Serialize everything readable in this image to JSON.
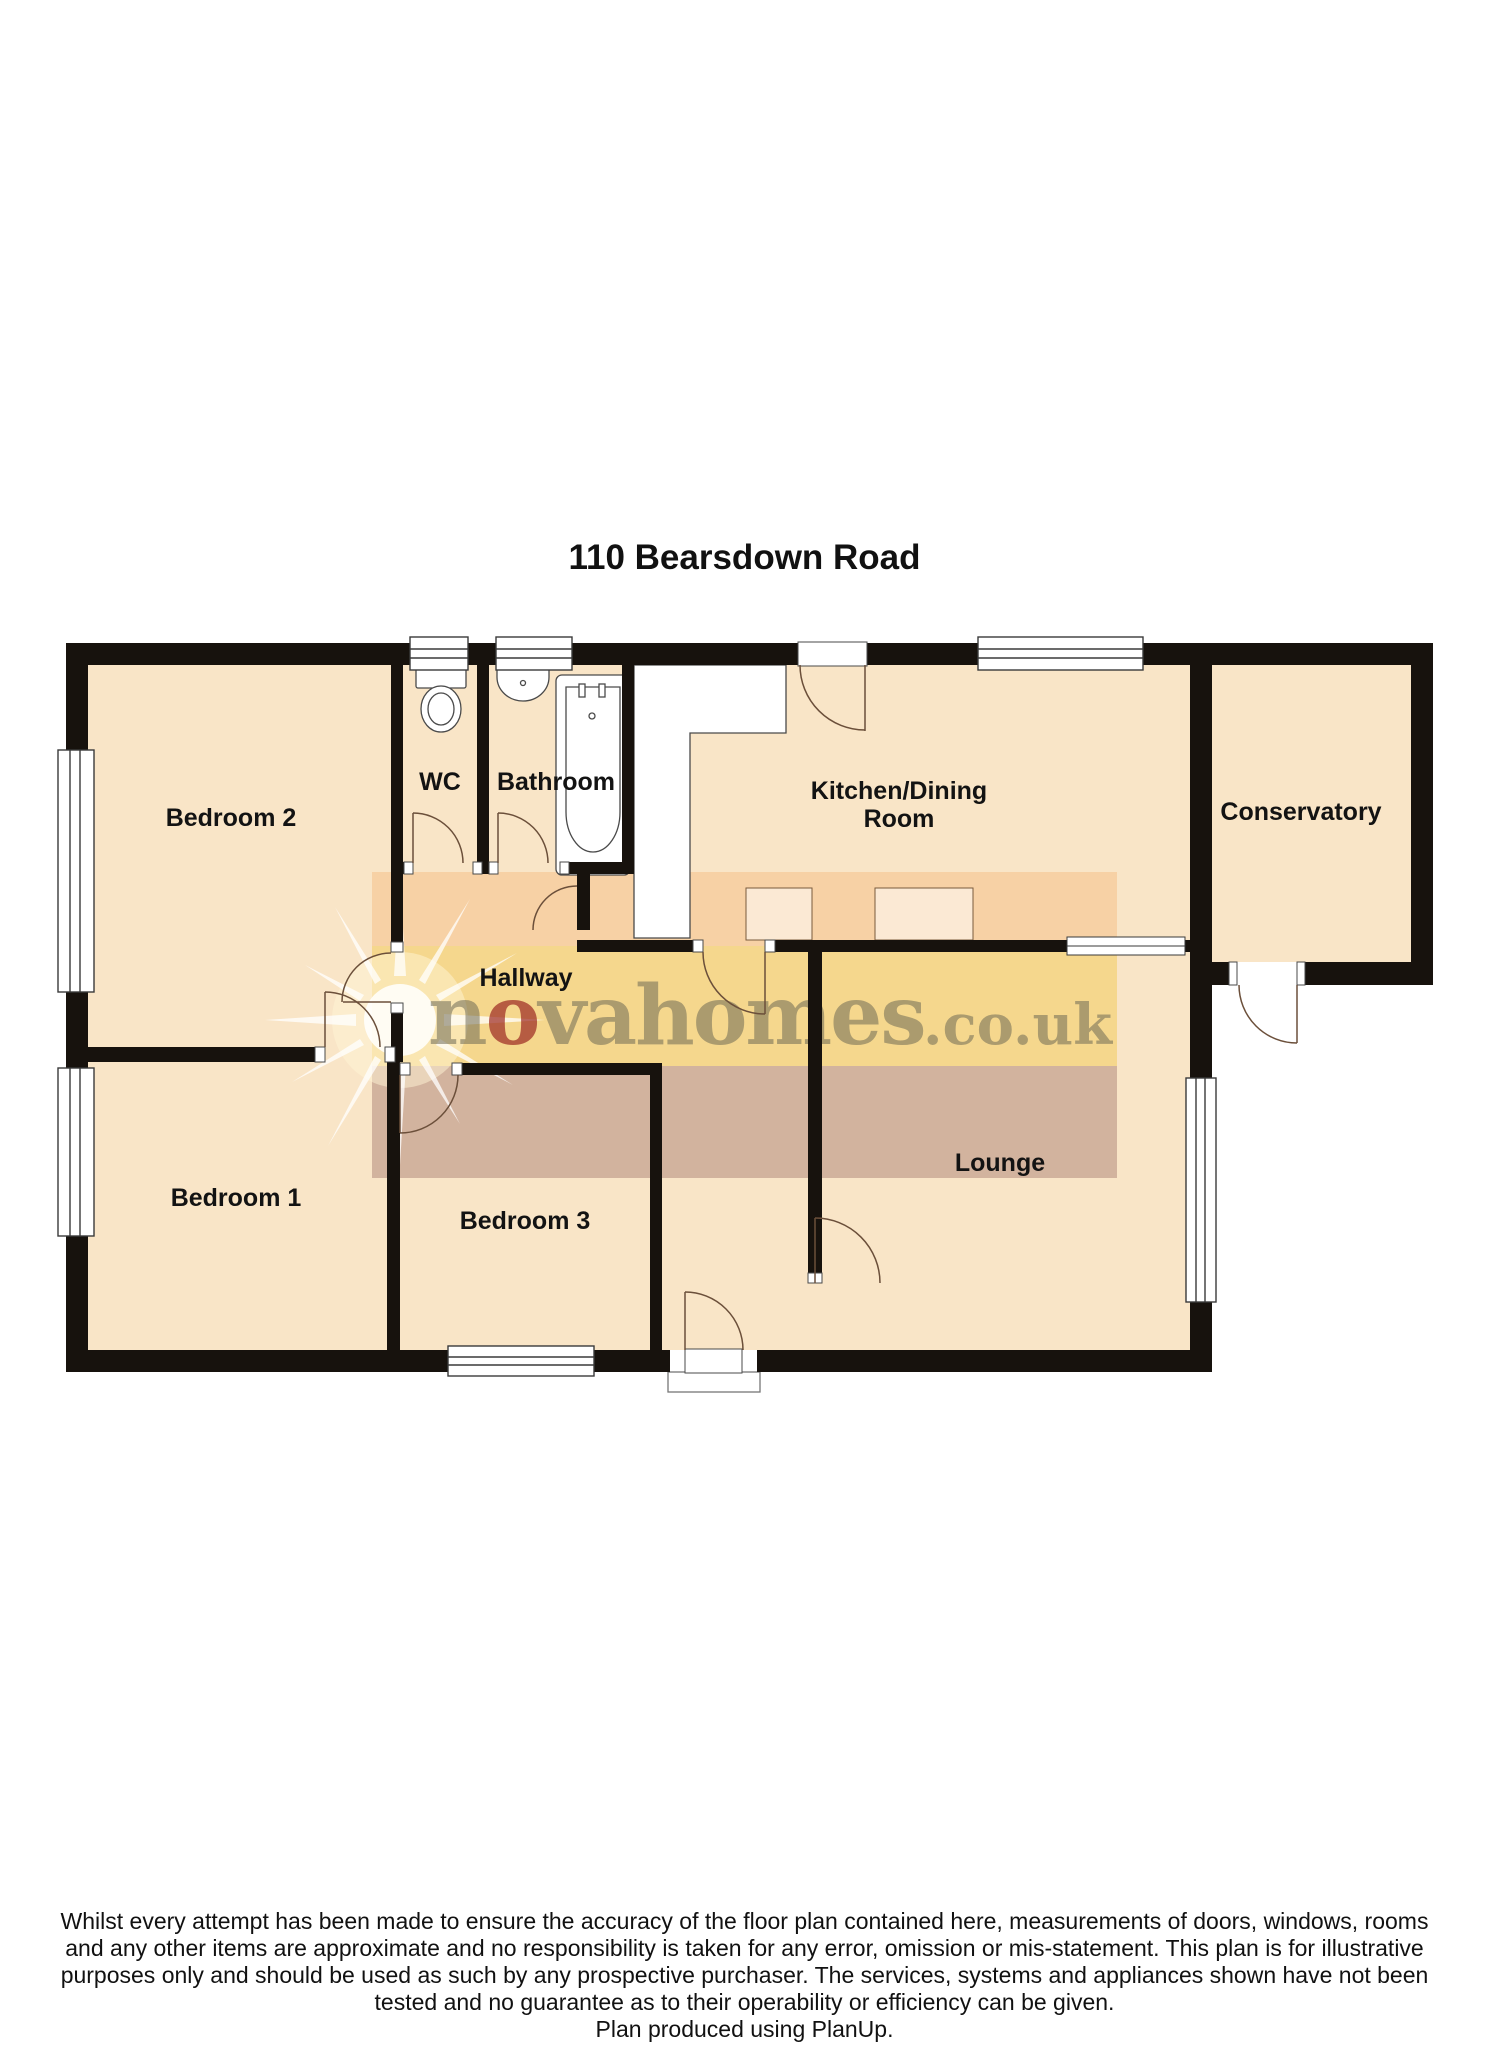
{
  "title": "110 Bearsdown Road",
  "floorplan": {
    "rooms": [
      {
        "id": "bedroom2",
        "label": "Bedroom 2"
      },
      {
        "id": "wc",
        "label": "WC"
      },
      {
        "id": "bathroom",
        "label": "Bathroom"
      },
      {
        "id": "kitchen_dining",
        "label_line1": "Kitchen/Dining",
        "label_line2": "Room"
      },
      {
        "id": "conservatory",
        "label": "Conservatory"
      },
      {
        "id": "hallway",
        "label": "Hallway"
      },
      {
        "id": "bedroom1",
        "label": "Bedroom 1"
      },
      {
        "id": "bedroom3",
        "label": "Bedroom 3"
      },
      {
        "id": "lounge",
        "label": "Lounge"
      }
    ],
    "fixtures": [
      "toilet",
      "basin",
      "bathtub",
      "kitchen-counter",
      "kitchen-units",
      "porch-step"
    ],
    "features": [
      "windows",
      "door-swings",
      "external-doors"
    ]
  },
  "watermark": {
    "part1": "n",
    "part2": "o",
    "part3": "vahomes",
    "suffix": ".co.uk"
  },
  "disclaimer": {
    "lines": [
      "Whilst every attempt has been made to ensure the accuracy of the floor plan contained here, measurements of doors, windows, rooms",
      "and any other items are approximate and no responsibility is taken for any error, omission or mis-statement.  This plan is for illustrative",
      "purposes only and should be used as such by any prospective purchaser.  The services, systems and appliances shown have not been",
      "tested and no guarantee as to their operability or efficiency can be given.",
      "Plan produced using PlanUp."
    ]
  },
  "colors": {
    "floor": "#F9E5C7",
    "wall": "#17120D",
    "line": "#6B4F3A",
    "band_peach": "rgba(242,163,85,0.30)",
    "band_gold": "rgba(240,198,70,0.45)",
    "band_mauve": "rgba(148,98,92,0.38)",
    "wm_text": "rgba(110,106,86,0.55)",
    "brand_red": "rgba(155,40,34,0.70)"
  }
}
